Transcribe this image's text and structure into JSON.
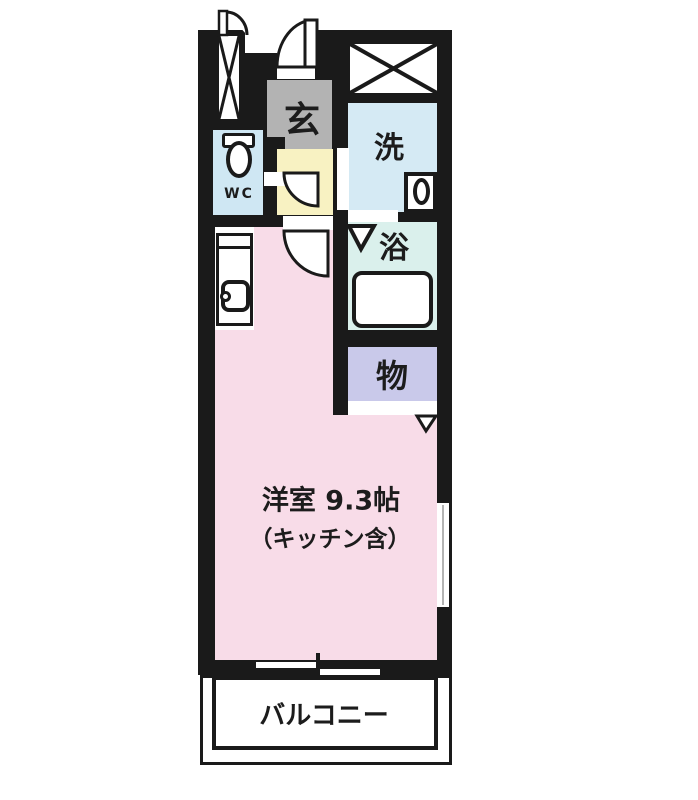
{
  "floorplan": {
    "rooms": {
      "genkan": {
        "label": "玄",
        "color": "#b3b3b3"
      },
      "wc": {
        "label": "WC",
        "color": "#cfe7f3"
      },
      "laundry": {
        "label": "洗",
        "color": "#d5eaf4"
      },
      "bath": {
        "label": "浴",
        "color": "#daf0ec"
      },
      "storage": {
        "label": "物",
        "color": "#c9c9ea"
      },
      "main_room": {
        "label": "洋室  9.3帖",
        "note": "（キッチン含）",
        "color": "#f8dce8"
      },
      "balcony": {
        "label": "バルコニー",
        "color": "#ffffff"
      }
    },
    "fixtures": [
      "toilet-icon",
      "washing-machine-icon",
      "bathtub-icon",
      "kitchen-sink-icon",
      "entrance-door-arc-icon",
      "interior-door-arc-icon",
      "wc-door-arc-icon",
      "pipe-shaft-x-icon",
      "closet-x-icon",
      "bath-entry-triangle-icon",
      "storage-entry-triangle-icon",
      "sliding-window-icon"
    ],
    "wall_color": "#1a1a1a"
  }
}
